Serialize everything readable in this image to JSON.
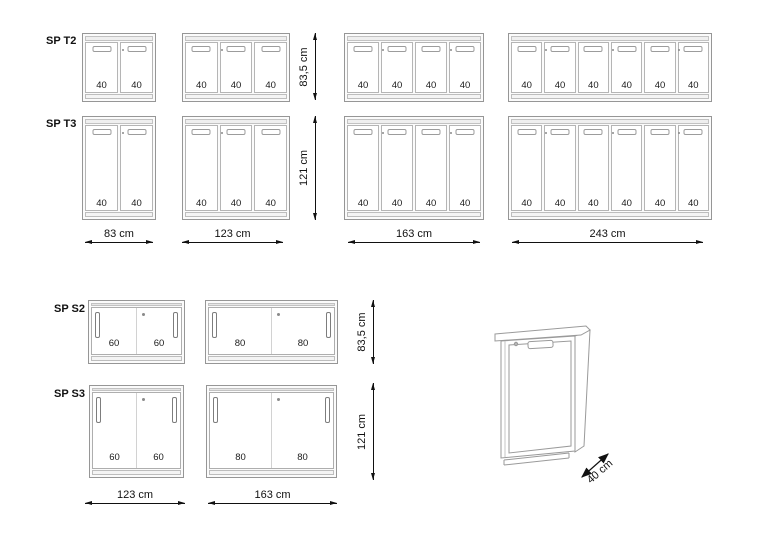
{
  "top_section": {
    "rows": [
      {
        "label": "SP T2",
        "height_dim": "83,5 cm",
        "cabinets": [
          {
            "doors": [
              "40",
              "40"
            ]
          },
          {
            "doors": [
              "40",
              "40",
              "40"
            ]
          },
          {
            "doors": [
              "40",
              "40",
              "40",
              "40"
            ]
          },
          {
            "doors": [
              "40",
              "40",
              "40",
              "40",
              "40",
              "40"
            ]
          }
        ]
      },
      {
        "label": "SP T3",
        "height_dim": "121 cm",
        "cabinets": [
          {
            "doors": [
              "40",
              "40"
            ]
          },
          {
            "doors": [
              "40",
              "40",
              "40"
            ]
          },
          {
            "doors": [
              "40",
              "40",
              "40",
              "40"
            ]
          },
          {
            "doors": [
              "40",
              "40",
              "40",
              "40",
              "40",
              "40"
            ]
          }
        ]
      }
    ],
    "width_dims": [
      "83 cm",
      "123 cm",
      "163 cm",
      "243 cm"
    ]
  },
  "bottom_section": {
    "rows": [
      {
        "label": "SP S2",
        "height_dim": "83,5 cm",
        "cabinets": [
          {
            "doors": [
              "60",
              "60"
            ]
          },
          {
            "doors": [
              "80",
              "80"
            ]
          }
        ]
      },
      {
        "label": "SP S3",
        "height_dim": "121 cm",
        "cabinets": [
          {
            "doors": [
              "60",
              "60"
            ]
          },
          {
            "doors": [
              "80",
              "80"
            ]
          }
        ]
      }
    ],
    "width_dims": [
      "123 cm",
      "163 cm"
    ]
  },
  "perspective_view": {
    "depth_dim": "40 cm"
  },
  "colors": {
    "line_gray": "#9a9a9a",
    "line_light": "#c4c4c4",
    "dimension_black": "#111111",
    "background": "#ffffff"
  }
}
